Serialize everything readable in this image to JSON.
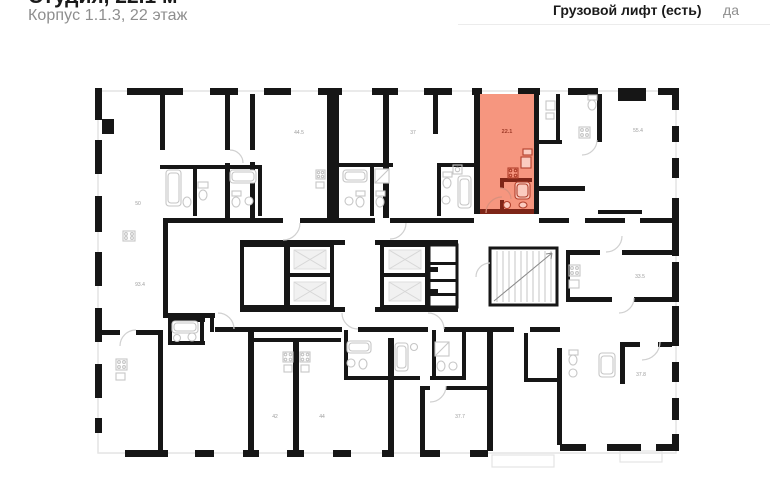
{
  "header": {
    "title": "Студия, 22.1 м²",
    "subtitle": "Корпус 1.1.3, 22 этаж"
  },
  "info": {
    "rows": [
      {
        "label": "Грузовой лифт (есть)",
        "value": "да"
      }
    ]
  },
  "floor_plan": {
    "highlighted_unit": {
      "label": "22.1"
    },
    "unit_labels": [
      "50",
      "44.5",
      "37",
      "55.4",
      "93.4",
      "33.5",
      "42",
      "44",
      "37.7",
      "37.8"
    ],
    "colors": {
      "highlight_fill": "#F6967F",
      "highlight_stroke": "#7E2517",
      "highlight_fixture": "#B1402C",
      "highlight_label": "#9E3B28",
      "wall": "#161616",
      "fixture": "#C6C6C6",
      "door": "#D0D0D0",
      "facade": "#E4E4E4",
      "label": "#9B9B9B",
      "divider": "#ECECEC",
      "text_primary": "#1A1A1A",
      "text_secondary": "#8E8E8E"
    }
  }
}
